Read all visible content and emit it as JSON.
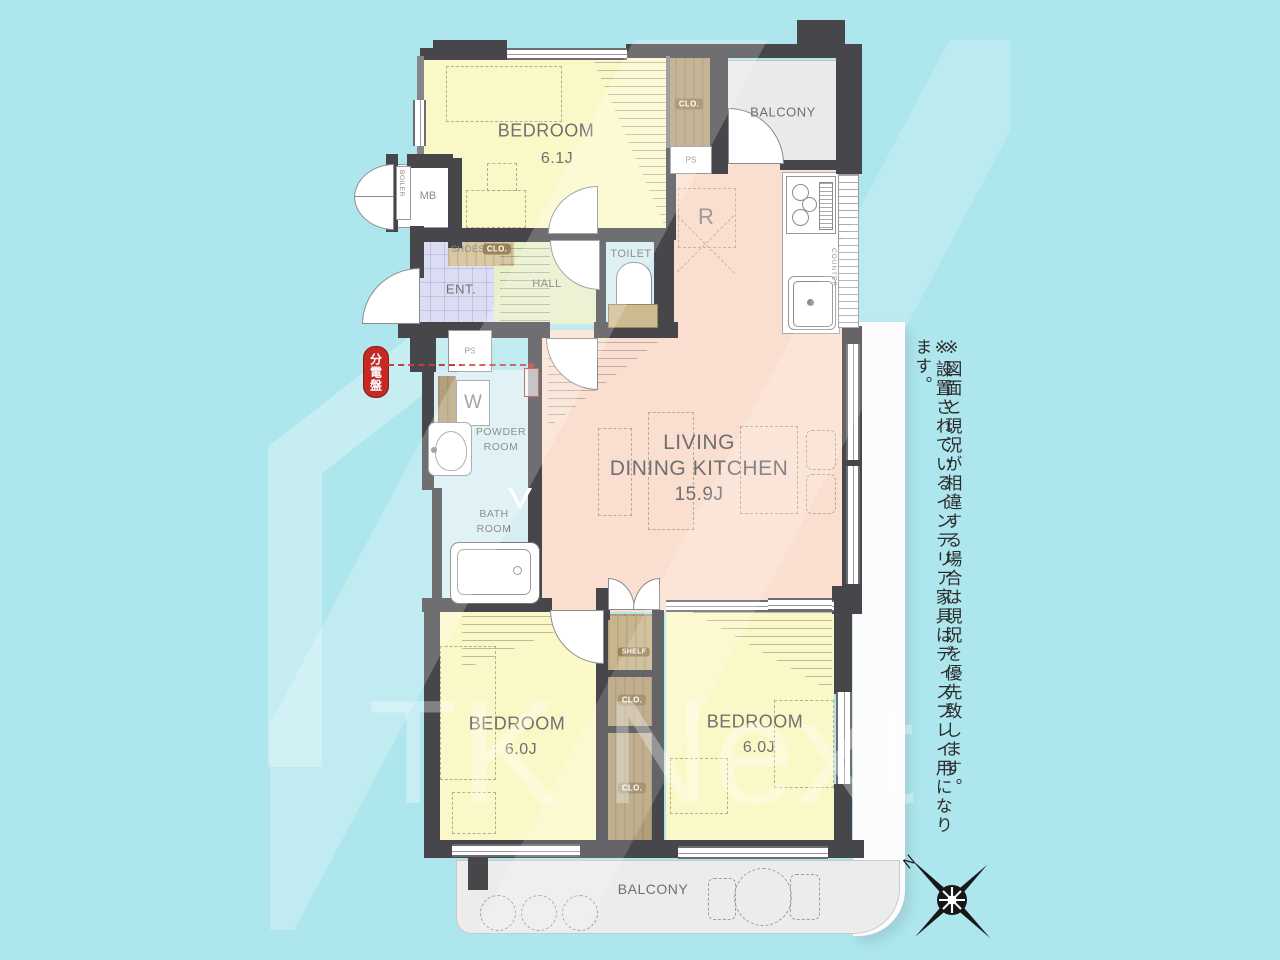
{
  "watermark": {
    "brand": "TK Next"
  },
  "notes": {
    "line1": "※図面と現況が相違する場合は現況を優先致します。",
    "line2": "※設置されているインテリア家具はディスプレイ用になります。"
  },
  "compass": {
    "north": "N"
  },
  "plan": {
    "bedroom_top": {
      "name": "BEDROOM",
      "size": "6.1J"
    },
    "ldk": {
      "line1": "LIVING",
      "line2": "DINING KITCHEN",
      "size": "15.9J"
    },
    "bedroom_left": {
      "name": "BEDROOM",
      "size": "6.0J"
    },
    "bedroom_right": {
      "name": "BEDROOM",
      "size": "6.0J"
    },
    "balcony_top": "BALCONY",
    "balcony_bottom": "BALCONY",
    "toilet": "TOILET",
    "hall": "HALL",
    "entrance": "ENT.",
    "shoes_closet": {
      "word1": "SHOES",
      "word2": "CLO."
    },
    "powder_room": {
      "line1": "POWDER",
      "line2": "ROOM"
    },
    "bath_room": {
      "line1": "BATH",
      "line2": "ROOM"
    },
    "meter_box": "MB",
    "boiler": "BOILER",
    "pipe_space_top": "PS",
    "pipe_space_mid": "PS",
    "closet_top": "CLO.",
    "shelf": "SHELF",
    "closet_mid": "CLO.",
    "closet_bottom": "CLO.",
    "refrigerator": "R",
    "washer": "W",
    "counter": "COUNTER",
    "distribution_board": "分電盤"
  }
}
